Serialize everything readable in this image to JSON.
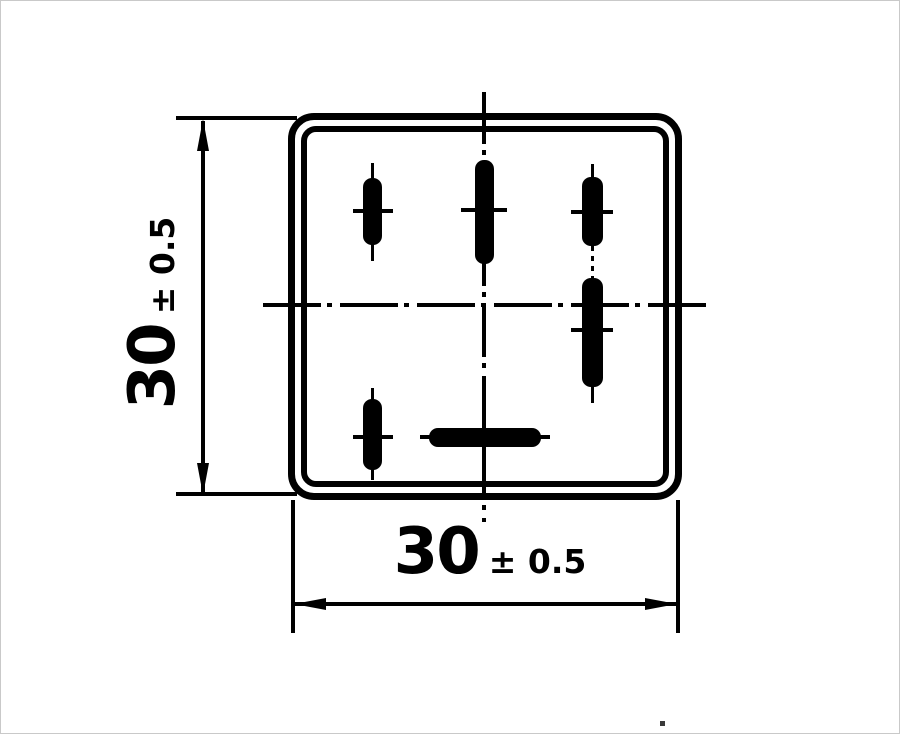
{
  "drawing": {
    "kind": "dimensioned outline drawing, bottom view of relay with terminal slots",
    "height_dimension": {
      "value": "30",
      "tolerance": "± 0.5"
    },
    "width_dimension": {
      "value": "30",
      "tolerance": "± 0.5"
    }
  },
  "colors": {
    "ink": "#000000",
    "paper": "#ffffff"
  }
}
